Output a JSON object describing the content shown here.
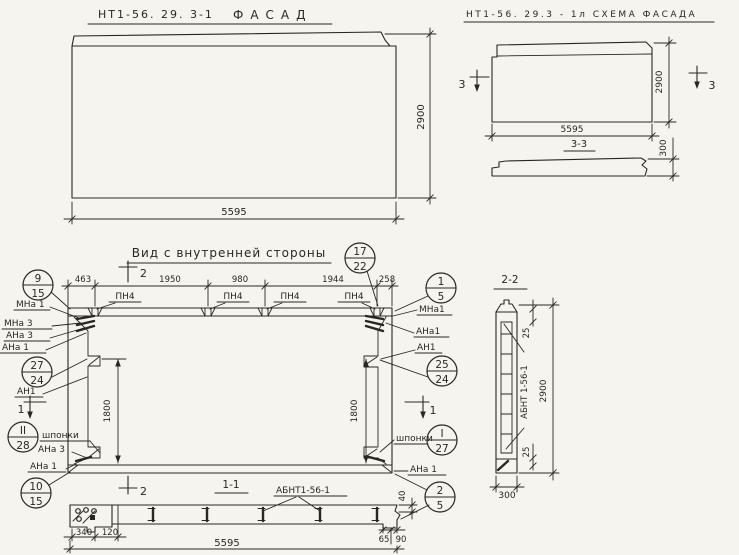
{
  "page": {
    "background": "#f5f4ef",
    "ink": "#2a2722"
  },
  "facade": {
    "code": "НТ1-56. 29. 3-1",
    "title": "ФАСАД",
    "dim_width": "5595",
    "dim_height": "2900"
  },
  "schema": {
    "title": "НТ1-56. 29.3 - 1л СХЕМА ФАСАДА",
    "dim_width": "5595",
    "dim_height": "2900",
    "mark": "3",
    "section_title": "3-3",
    "dim_thickness": "300"
  },
  "inner": {
    "title": "Вид с внутренней стороны",
    "dims_top": [
      "463",
      "1950",
      "980",
      "1944",
      "258"
    ],
    "anchor_label": "ПН4",
    "dim_vert": "1800",
    "keys_label": "шпонки",
    "mark_1": "1",
    "mark_2": "2",
    "labels_left": {
      "mna1": "МНа 1",
      "mna3": "МНа 3",
      "ana3": "АНа 3",
      "ana1": "АНа 1",
      "an1": "АН1",
      "ana3b": "АНа 3",
      "ana1b": "АНа 1"
    },
    "labels_right": {
      "mna1": "МНа1",
      "ana1": "АНа1",
      "an1": "АН1",
      "ana1b": "АНа 1"
    },
    "callouts": {
      "c9_15": {
        "top": "9",
        "bottom": "15"
      },
      "c17_22": {
        "top": "17",
        "bottom": "22"
      },
      "c1_5": {
        "top": "1",
        "bottom": "5"
      },
      "c27_24": {
        "top": "27",
        "bottom": "24"
      },
      "c25_24": {
        "top": "25",
        "bottom": "24"
      },
      "cII_28": {
        "top": "II",
        "bottom": "28"
      },
      "cI_27": {
        "top": "I",
        "bottom": "27"
      },
      "c10_15": {
        "top": "10",
        "bottom": "15"
      },
      "c2_5": {
        "top": "2",
        "bottom": "5"
      }
    }
  },
  "sec11": {
    "title": "1-1",
    "part_label": "АБНТ1-56-1",
    "dim_340": "340",
    "dim_120": "120",
    "dim_40": "40",
    "dim_65": "65",
    "dim_90": "90",
    "dim_total": "5595"
  },
  "sec22": {
    "title": "2-2",
    "part_label": "АБНТ 1-56-1",
    "dim_top": "25",
    "dim_bottom": "25",
    "dim_height": "2900",
    "dim_width": "300"
  }
}
